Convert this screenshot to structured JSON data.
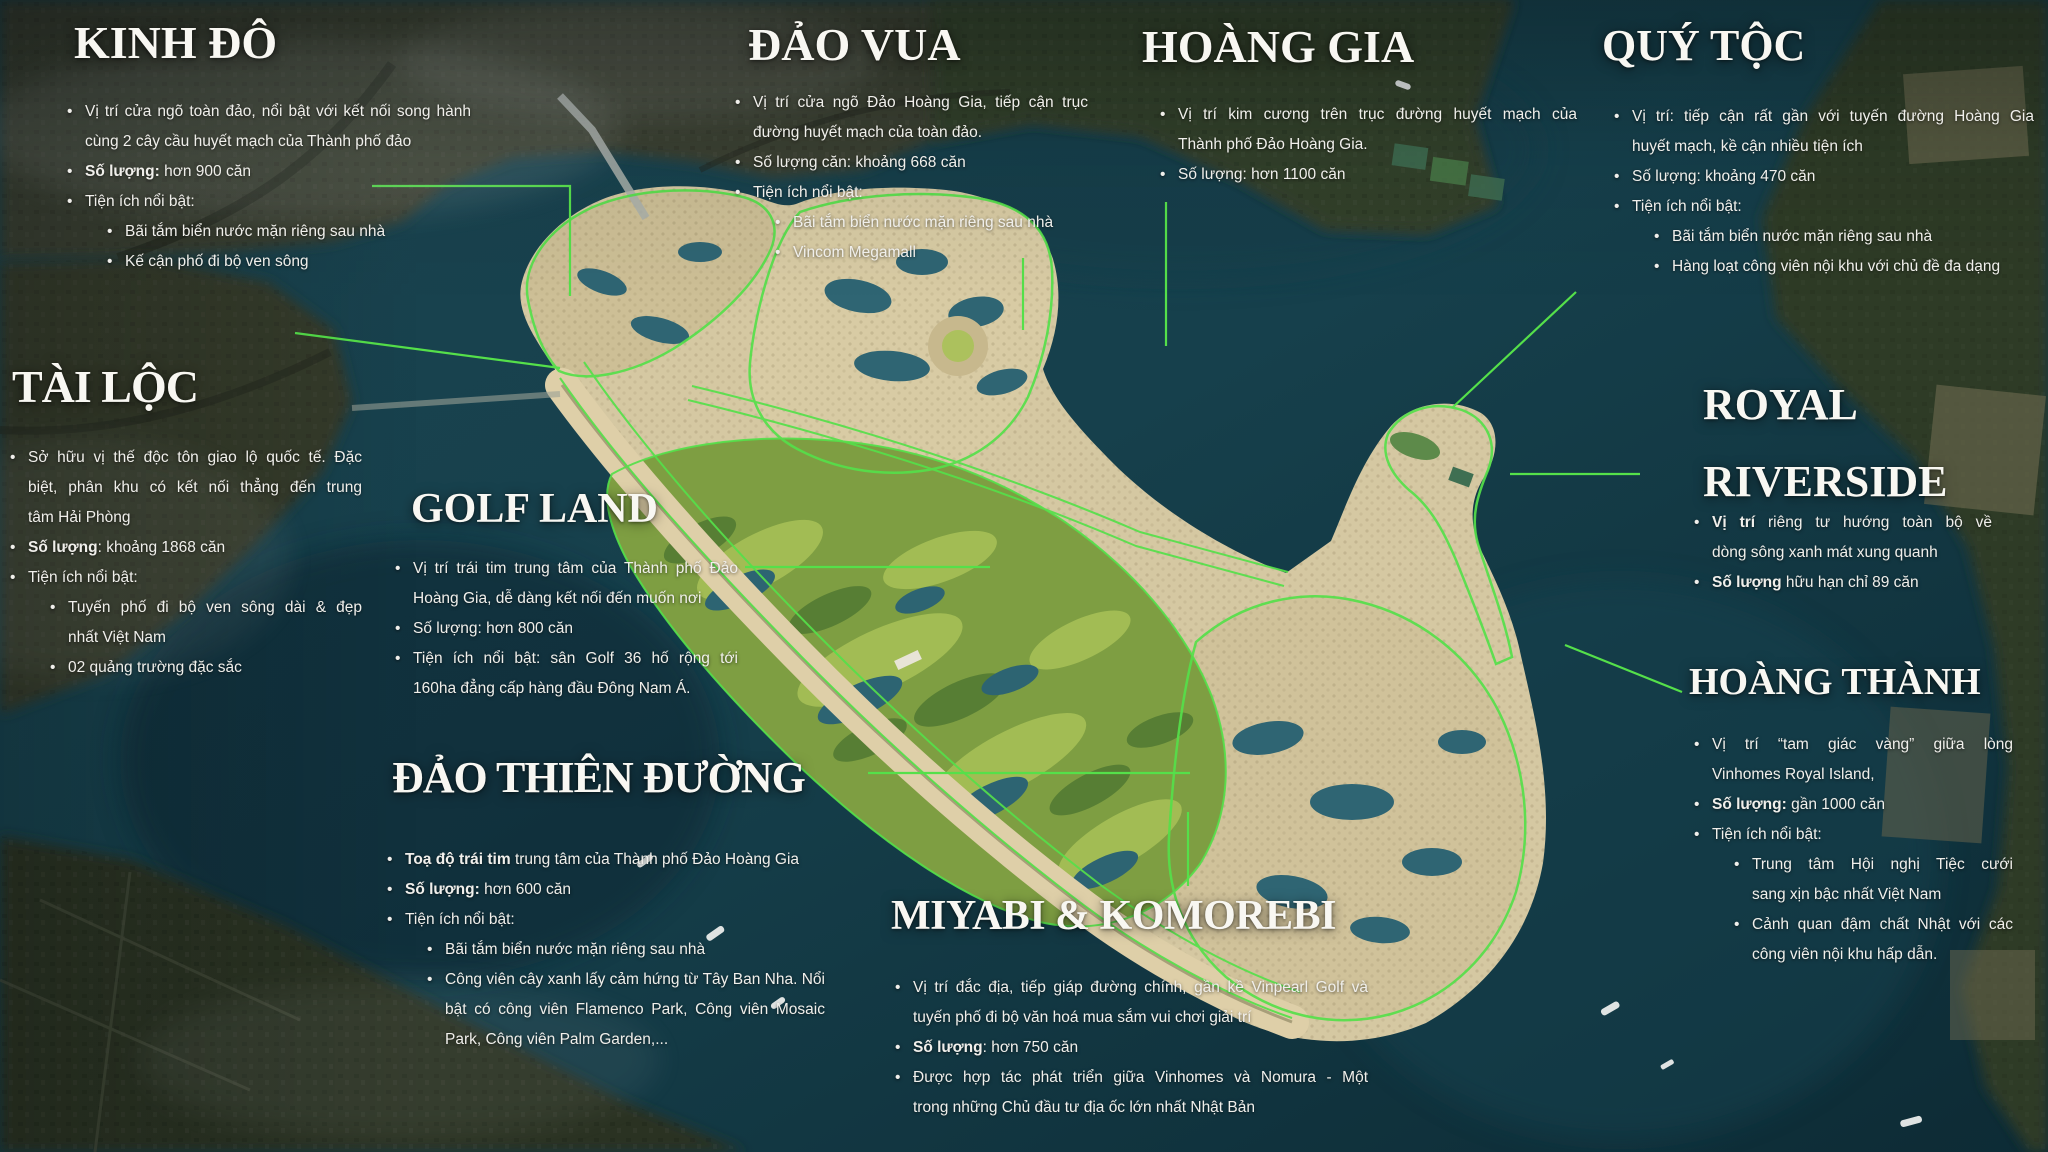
{
  "colors": {
    "accent_green": "#55e04a",
    "water": "#16404c",
    "island_sand": "#d5c8a2",
    "golf_green": "#7e9e42",
    "text": "#f5f4ef"
  },
  "sections": [
    {
      "id": "kinh-do",
      "title_lines": [
        "KINH ĐÔ"
      ],
      "bullets": [
        {
          "level": 1,
          "lines": [
            [
              {
                "t": "Vị trí cửa ngõ toàn đảo, nổi bật với kết nối song hành",
                "b": false
              }
            ],
            [
              {
                "t": "cùng 2 cây cầu huyết mạch của Thành phố đảo",
                "b": false
              }
            ]
          ]
        },
        {
          "level": 1,
          "lines": [
            [
              {
                "t": "Số lượng:",
                "b": true
              },
              {
                "t": " hơn 900 căn",
                "b": false
              }
            ]
          ]
        },
        {
          "level": 1,
          "lines": [
            [
              {
                "t": "Tiện ích nổi bật:",
                "b": false
              }
            ]
          ]
        },
        {
          "level": 2,
          "lines": [
            [
              {
                "t": "Bãi tắm biển nước mặn riêng sau nhà",
                "b": false
              }
            ]
          ]
        },
        {
          "level": 2,
          "lines": [
            [
              {
                "t": "Kế cận phố đi bộ ven sông",
                "b": false
              }
            ]
          ]
        }
      ]
    },
    {
      "id": "dao-vua",
      "title_lines": [
        "ĐẢO VUA"
      ],
      "bullets": [
        {
          "level": 1,
          "lines": [
            [
              {
                "t": "Vị trí cửa ngõ Đảo Hoàng Gia, tiếp cận trục",
                "b": false
              }
            ],
            [
              {
                "t": "đường huyết mạch của toàn đảo.",
                "b": false
              }
            ]
          ]
        },
        {
          "level": 1,
          "lines": [
            [
              {
                "t": "Số lượng căn: khoảng 668 căn",
                "b": false
              }
            ]
          ]
        },
        {
          "level": 1,
          "lines": [
            [
              {
                "t": "Tiện ích nổi bật:",
                "b": false
              }
            ]
          ]
        },
        {
          "level": 2,
          "lines": [
            [
              {
                "t": "Bãi tắm biển nước mặn riêng sau nhà",
                "b": false
              }
            ]
          ]
        },
        {
          "level": 2,
          "lines": [
            [
              {
                "t": "Vincom Megamall",
                "b": false
              }
            ]
          ]
        }
      ]
    },
    {
      "id": "hoang-gia",
      "title_lines": [
        "HOÀNG GIA"
      ],
      "bullets": [
        {
          "level": 1,
          "lines": [
            [
              {
                "t": "Vị trí kim cương trên trục đường huyết mạch của",
                "b": false
              }
            ],
            [
              {
                "t": "Thành phố Đảo Hoàng Gia.",
                "b": false
              }
            ]
          ]
        },
        {
          "level": 1,
          "lines": [
            [
              {
                "t": "Số lượng: hơn 1100 căn",
                "b": false
              }
            ]
          ]
        }
      ]
    },
    {
      "id": "quy-toc",
      "title_lines": [
        "QUÝ TỘC"
      ],
      "bullets": [
        {
          "level": 1,
          "lines": [
            [
              {
                "t": "Vị trí: tiếp cận rất gần với tuyến đường Hoàng Gia",
                "b": false
              }
            ],
            [
              {
                "t": "huyết mạch, kề cận nhiều tiện ích",
                "b": false
              }
            ]
          ]
        },
        {
          "level": 1,
          "lines": [
            [
              {
                "t": "Số lượng: khoảng 470 căn",
                "b": false
              }
            ]
          ]
        },
        {
          "level": 1,
          "lines": [
            [
              {
                "t": "Tiện ích nổi bật:",
                "b": false
              }
            ]
          ]
        },
        {
          "level": 2,
          "lines": [
            [
              {
                "t": "Bãi tắm biển nước mặn riêng sau nhà",
                "b": false
              }
            ]
          ]
        },
        {
          "level": 2,
          "lines": [
            [
              {
                "t": "Hàng loạt công viên nội khu với chủ đề đa dạng",
                "b": false
              }
            ]
          ]
        }
      ]
    },
    {
      "id": "tai-loc",
      "title_lines": [
        "TÀI LỘC"
      ],
      "bullets": [
        {
          "level": 1,
          "lines": [
            [
              {
                "t": "Sở hữu vị thế độc tôn giao lộ quốc tế. Đặc",
                "b": false
              }
            ],
            [
              {
                "t": "biệt, phân khu có kết nối thẳng đến trung",
                "b": false
              }
            ],
            [
              {
                "t": "tâm Hải Phòng",
                "b": false
              }
            ]
          ]
        },
        {
          "level": 1,
          "lines": [
            [
              {
                "t": "Số lượng",
                "b": true
              },
              {
                "t": ": khoảng 1868 căn",
                "b": false
              }
            ]
          ]
        },
        {
          "level": 1,
          "lines": [
            [
              {
                "t": "Tiện ích nổi bật:",
                "b": false
              }
            ]
          ]
        },
        {
          "level": 2,
          "lines": [
            [
              {
                "t": "Tuyến phố đi bộ ven sông dài & đẹp",
                "b": false
              }
            ],
            [
              {
                "t": "nhất Việt Nam",
                "b": false
              }
            ]
          ]
        },
        {
          "level": 2,
          "lines": [
            [
              {
                "t": "02 quảng trường đặc sắc",
                "b": false
              }
            ]
          ]
        }
      ]
    },
    {
      "id": "golf-land",
      "title_lines": [
        "GOLF LAND"
      ],
      "bullets": [
        {
          "level": 1,
          "lines": [
            [
              {
                "t": "Vị trí trái tim trung tâm của Thành phố Đảo",
                "b": false
              }
            ],
            [
              {
                "t": "Hoàng Gia, dễ dàng kết nối đến muốn nơi",
                "b": false
              }
            ]
          ]
        },
        {
          "level": 1,
          "lines": [
            [
              {
                "t": "Số lượng: hơn 800 căn",
                "b": false
              }
            ]
          ]
        },
        {
          "level": 1,
          "lines": [
            [
              {
                "t": "Tiện ích nổi bật: sân Golf 36 hố rộng tới",
                "b": false
              }
            ],
            [
              {
                "t": "160ha đẳng cấp hàng đầu Đông Nam Á.",
                "b": false
              }
            ]
          ]
        }
      ]
    },
    {
      "id": "dao-thien-duong",
      "title_lines": [
        "ĐẢO THIÊN ĐƯỜNG"
      ],
      "bullets": [
        {
          "level": 1,
          "lines": [
            [
              {
                "t": "Toạ độ trái tim",
                "b": true
              },
              {
                "t": " trung tâm của Thành phố Đảo Hoàng Gia",
                "b": false
              }
            ]
          ]
        },
        {
          "level": 1,
          "lines": [
            [
              {
                "t": "Số lượng:",
                "b": true
              },
              {
                "t": " hơn 600 căn",
                "b": false
              }
            ]
          ]
        },
        {
          "level": 1,
          "lines": [
            [
              {
                "t": "Tiện ích nổi bật:",
                "b": false
              }
            ]
          ]
        },
        {
          "level": 2,
          "lines": [
            [
              {
                "t": "Bãi tắm biển nước mặn riêng sau nhà",
                "b": false
              }
            ]
          ]
        },
        {
          "level": 2,
          "lines": [
            [
              {
                "t": "Công viên cây xanh lấy cảm hứng từ Tây Ban Nha. Nổi",
                "b": false
              }
            ],
            [
              {
                "t": "bật có công viên Flamenco Park, Công viên Mosaic",
                "b": false
              }
            ],
            [
              {
                "t": "Park, Công viên Palm Garden,...",
                "b": false
              }
            ]
          ]
        }
      ]
    },
    {
      "id": "miyabi-komorebi",
      "title_lines": [
        "MIYABI & KOMOREBI"
      ],
      "bullets": [
        {
          "level": 1,
          "lines": [
            [
              {
                "t": "Vị trí đắc địa, tiếp giáp đường chính, gần kề Vinpearl Golf và",
                "b": false
              }
            ],
            [
              {
                "t": "tuyến phố đi bộ văn hoá mua sắm vui chơi giải trí",
                "b": false
              }
            ]
          ]
        },
        {
          "level": 1,
          "lines": [
            [
              {
                "t": "Số lượng",
                "b": true
              },
              {
                "t": ": hơn 750 căn",
                "b": false
              }
            ]
          ]
        },
        {
          "level": 1,
          "lines": [
            [
              {
                "t": "Được hợp tác phát triển giữa Vinhomes và Nomura - Một",
                "b": false
              }
            ],
            [
              {
                "t": "trong những Chủ đầu tư địa ốc lớn nhất Nhật Bản",
                "b": false
              }
            ]
          ]
        }
      ]
    },
    {
      "id": "royal-riverside",
      "title_lines": [
        "ROYAL",
        "RIVERSIDE"
      ],
      "bullets": [
        {
          "level": 1,
          "lines": [
            [
              {
                "t": "Vị trí",
                "b": true
              },
              {
                "t": " riêng tư hướng toàn bộ về",
                "b": false
              }
            ],
            [
              {
                "t": "dòng sông xanh mát xung quanh",
                "b": false
              }
            ]
          ]
        },
        {
          "level": 1,
          "lines": [
            [
              {
                "t": "Số lượng",
                "b": true
              },
              {
                "t": " hữu hạn chỉ 89 căn",
                "b": false
              }
            ]
          ]
        }
      ]
    },
    {
      "id": "hoang-thanh",
      "title_lines": [
        "HOÀNG THÀNH"
      ],
      "bullets": [
        {
          "level": 1,
          "lines": [
            [
              {
                "t": "Vị trí “tam giác vàng” giữa lòng",
                "b": false
              }
            ],
            [
              {
                "t": "Vinhomes Royal Island,",
                "b": false
              }
            ]
          ]
        },
        {
          "level": 1,
          "lines": [
            [
              {
                "t": "Số lượng:",
                "b": true
              },
              {
                "t": " gần 1000 căn",
                "b": false
              }
            ]
          ]
        },
        {
          "level": 1,
          "lines": [
            [
              {
                "t": "Tiện ích nổi bật:",
                "b": false
              }
            ]
          ]
        },
        {
          "level": 2,
          "lines": [
            [
              {
                "t": "Trung tâm Hội nghị Tiệc cưới",
                "b": false
              }
            ],
            [
              {
                "t": "sang xịn bậc nhất Việt Nam",
                "b": false
              }
            ]
          ]
        },
        {
          "level": 2,
          "lines": [
            [
              {
                "t": "Cảnh quan đậm chất Nhật với các",
                "b": false
              }
            ],
            [
              {
                "t": "công viên nội khu hấp dẫn.",
                "b": false
              }
            ]
          ]
        }
      ]
    }
  ]
}
